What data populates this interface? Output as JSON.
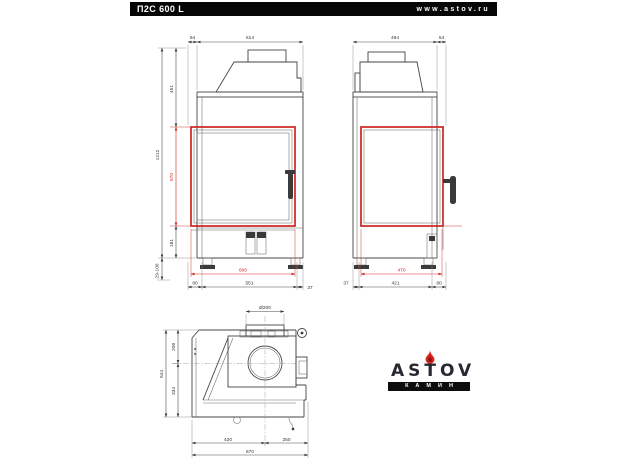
{
  "header": {
    "model": "П2С 600 L",
    "website": "www.astov.ru"
  },
  "front": {
    "dims": {
      "top_offset": "54",
      "top_width": "614",
      "height_total": "1212",
      "height_upper": "451",
      "glass_height": "570",
      "height_lower": "181",
      "legs_range": "29-100",
      "glass_width": "600",
      "bottom_left": "80",
      "bottom_center": "551",
      "bottom_right": "37"
    }
  },
  "side": {
    "dims": {
      "top_depth": "484",
      "top_offset": "54",
      "glass_depth": "470",
      "bottom_left": "37",
      "bottom_center": "421",
      "bottom_right": "80"
    }
  },
  "plan": {
    "dims": {
      "flue_diameter": "Ø200",
      "depth_total": "544",
      "depth_rear": "208",
      "depth_front": "334",
      "width_left": "420",
      "width_right": "250",
      "width_total": "670"
    }
  },
  "logo": {
    "brand": "ASTOV",
    "subtitle": "КАМИН"
  },
  "colors": {
    "accent_red": "#cf2420",
    "line": "#454545",
    "header_bg": "#060606"
  }
}
